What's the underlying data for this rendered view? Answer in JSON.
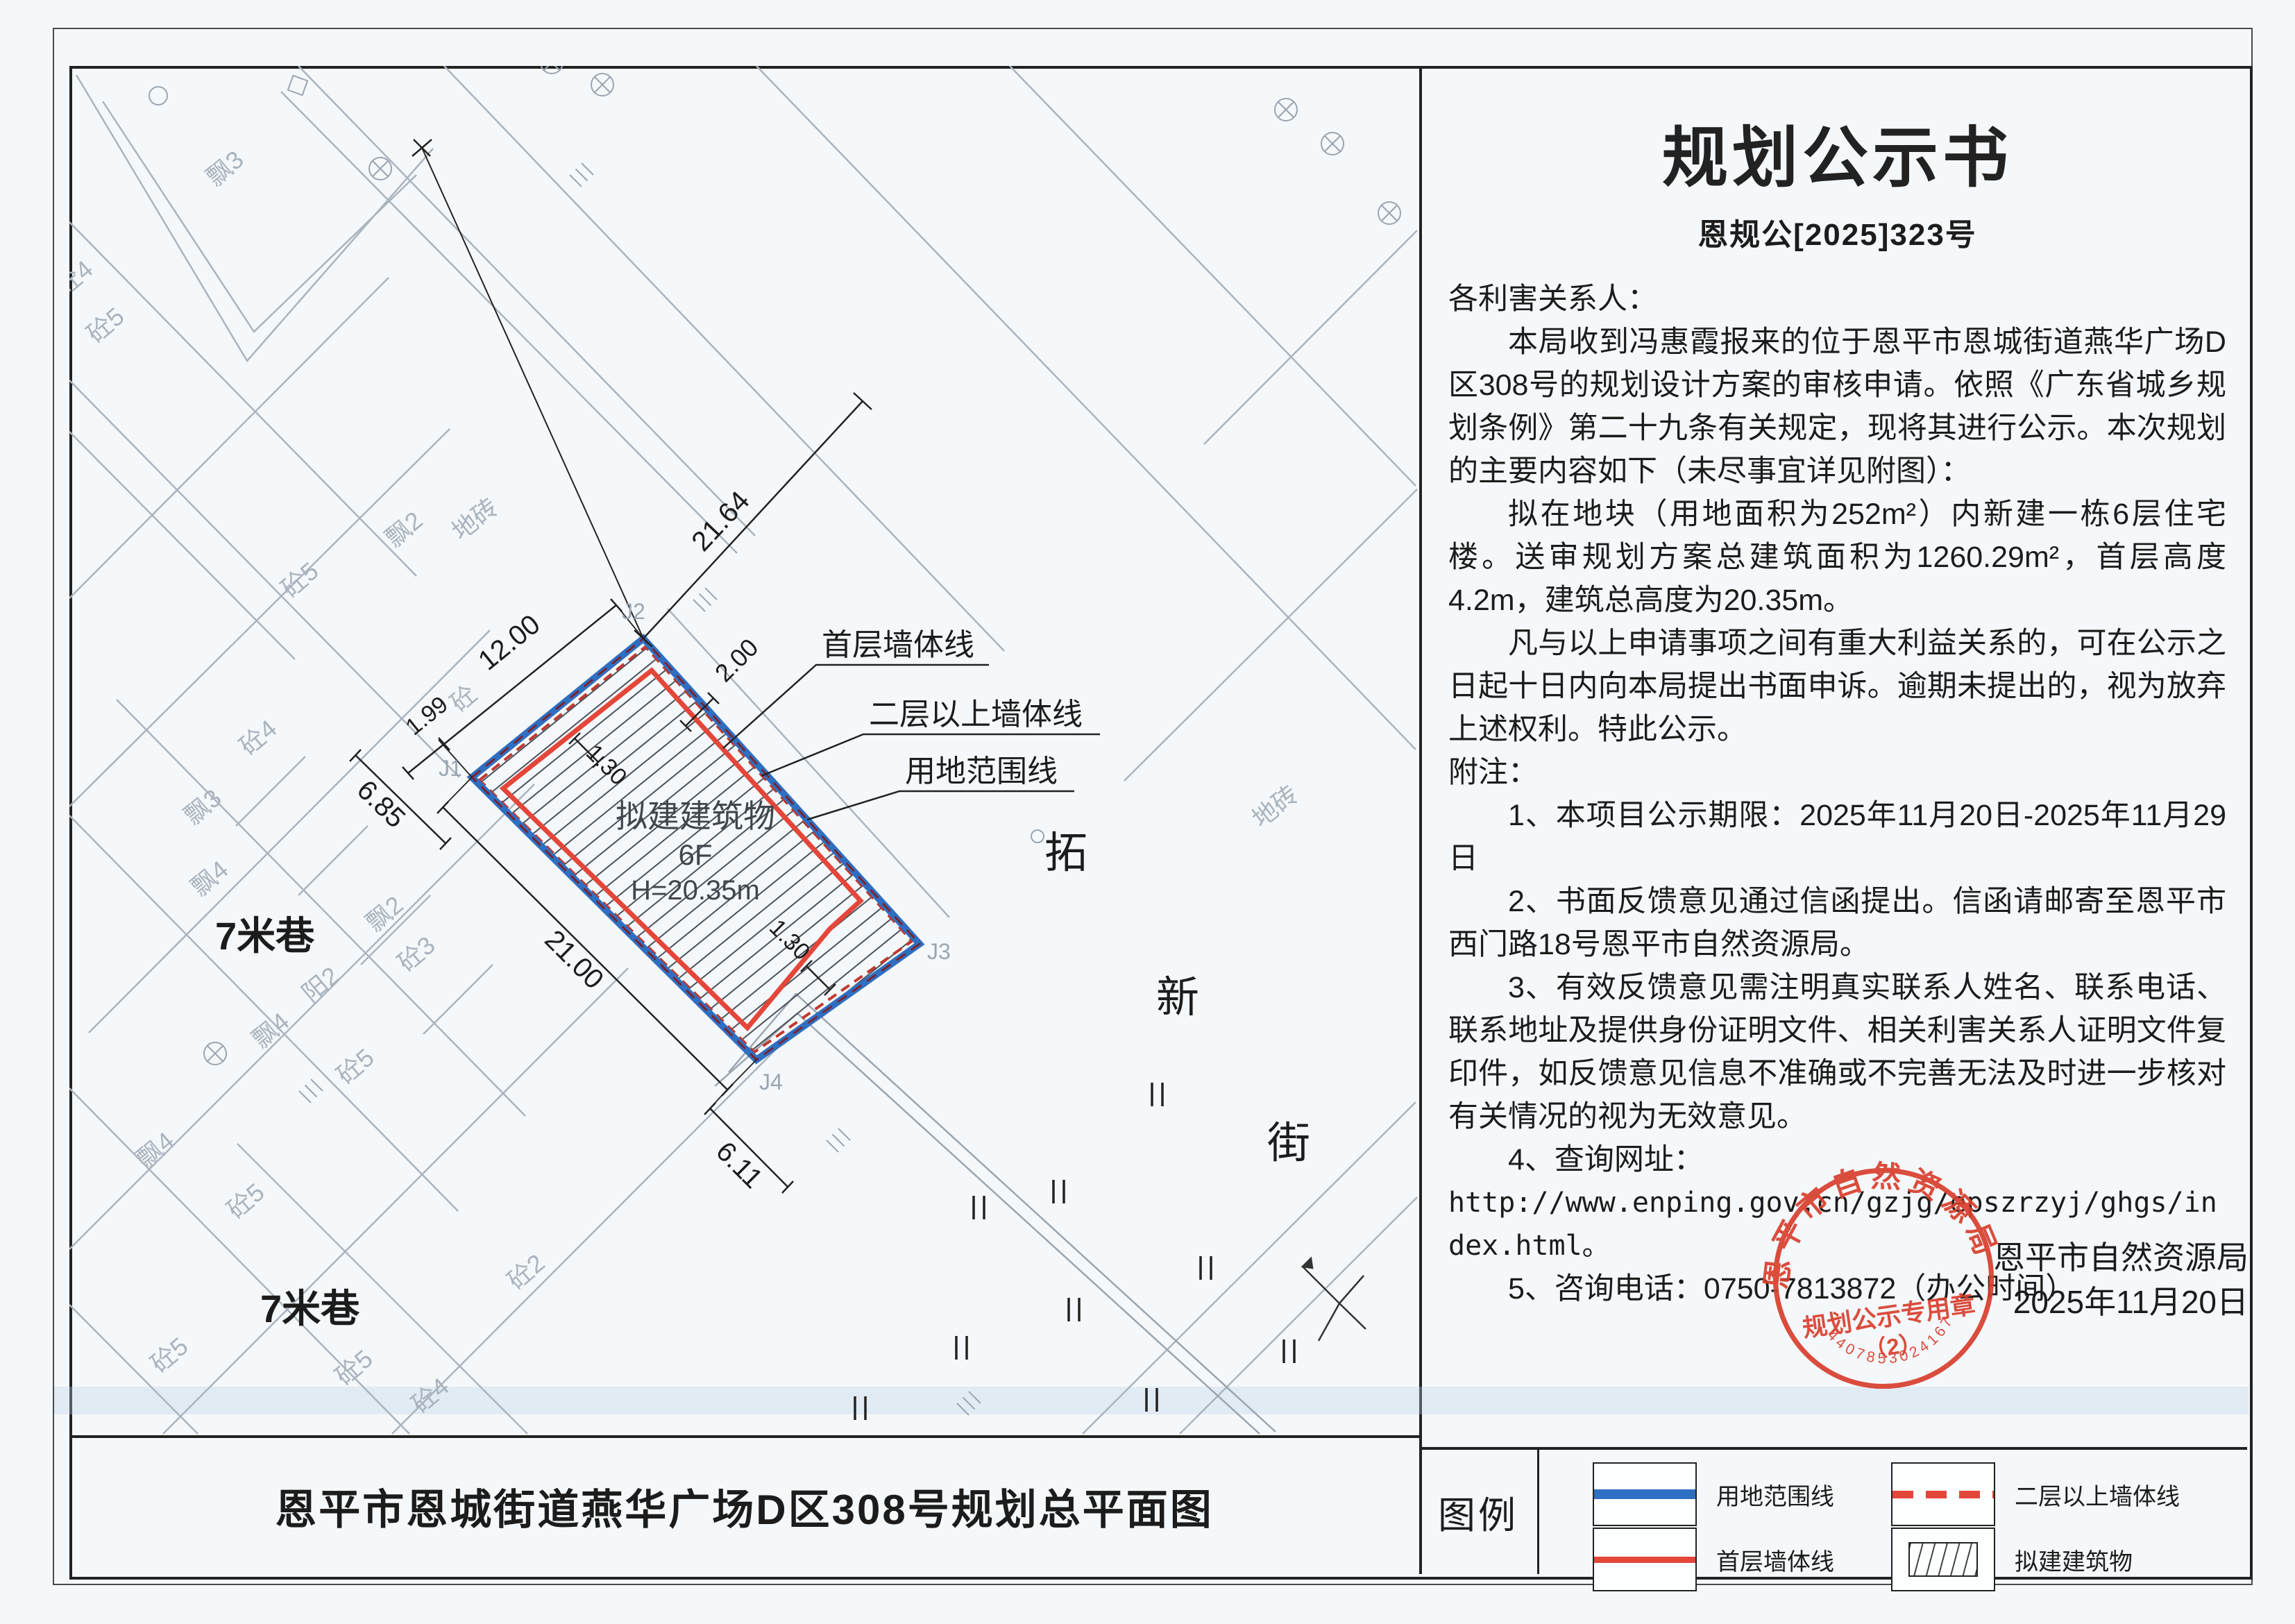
{
  "notice": {
    "title": "规划公示书",
    "doc_no": "恩规公[2025]323号",
    "salutation": "各利害关系人：",
    "p1": "本局收到冯惠霞报来的位于恩平市恩城街道燕华广场D区308号的规划设计方案的审核申请。依照《广东省城乡规划条例》第二十九条有关规定，现将其进行公示。本次规划的主要内容如下（未尽事宜详见附图）：",
    "p2": "拟在地块（用地面积为252m²）内新建一栋6层住宅楼。送审规划方案总建筑面积为1260.29m²，首层高度4.2m，建筑总高度为20.35m。",
    "p3": "凡与以上申请事项之间有重大利益关系的，可在公示之日起十日内向本局提出书面申诉。逾期未提出的，视为放弃上述权利。特此公示。",
    "notes_label": "附注：",
    "note1": "1、本项目公示期限：2025年11月20日-2025年11月29日",
    "note2": "2、书面反馈意见通过信函提出。信函请邮寄至恩平市西门路18号恩平市自然资源局。",
    "note3": "3、有效反馈意见需注明真实联系人姓名、联系电话、联系地址及提供身份证明文件、相关利害关系人证明文件复印件，如反馈意见信息不准确或不完善无法及时进一步核对有关情况的视为无效意见。",
    "note4": "4、查询网址：",
    "url": "http://www.enping.gov.cn/gzjg/epszrzyj/ghgs/index.html。",
    "note5": "5、咨询电话：0750-7813872（办公时间）",
    "issuer": "恩平市自然资源局",
    "date": "2025年11月20日"
  },
  "stamp": {
    "org": "恩平市自然资源局",
    "purpose": "规划公示专用章",
    "number": "（2）",
    "serial": "4407853024167",
    "color": "#d9412f"
  },
  "map": {
    "caption": "恩平市恩城街道燕华广场D区308号规划总平面图",
    "building": {
      "name": "拟建建筑物",
      "floors": "6F",
      "height": "H=20.35m"
    },
    "callout_first_floor": "首层墙体线",
    "callout_upper_floor": "二层以上墙体线",
    "callout_boundary": "用地范围线",
    "dims": {
      "top": "21.64",
      "left_edge": "12.00",
      "small": "1.99",
      "lane_w": "6.85",
      "setback": "2.00",
      "inset_a": "1.30",
      "inset_b": "1.30",
      "long_edge": "21.00",
      "bottom": "6.11"
    },
    "points": {
      "j1": "J1",
      "j2": "J2",
      "j3": "J3",
      "j4": "J4"
    },
    "lane_label_1": "7米巷",
    "lane_label_2": "7米巷",
    "street": {
      "c1": "拓",
      "c2": "新",
      "c3": "街"
    },
    "parcels": [
      "砼4",
      "砼5",
      "飘3",
      "砼5",
      "飘2",
      "地砖",
      "砼",
      "砼4",
      "飘3",
      "飘4",
      "砼3",
      "飘2",
      "阳2",
      "飘4",
      "砼5",
      "飘4",
      "砼5",
      "砼2",
      "砼5",
      "砼5",
      "砼4",
      "砼5",
      "飘4",
      "地砖"
    ],
    "colors": {
      "boundary": "#2f6fc1",
      "first_floor": "#e4463a",
      "upper_floor": "#b03431",
      "gray": "#aab4be"
    }
  },
  "legend": {
    "label": "图例",
    "item_boundary": "用地范围线",
    "item_upper": "二层以上墙体线",
    "item_first": "首层墙体线",
    "item_building": "拟建建筑物"
  }
}
